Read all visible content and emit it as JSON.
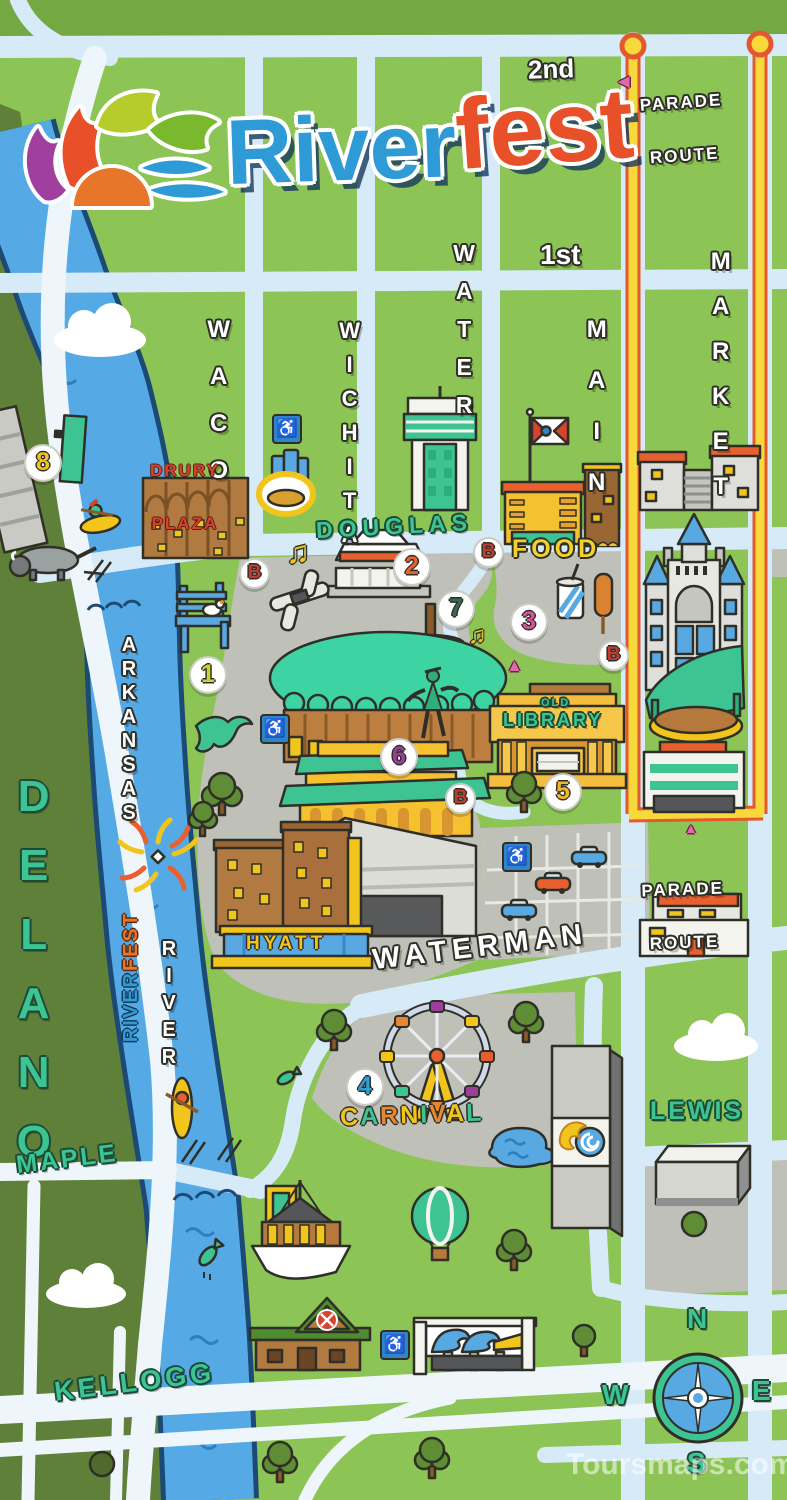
{
  "logo": {
    "blue_word": "River",
    "orange_word": "fest"
  },
  "streets": {
    "second": "2nd",
    "first": "1st",
    "waco": "WACO",
    "wichita": "WICHITA",
    "water": "WATER",
    "main": "MAIN",
    "market": "MARKET",
    "douglas": "DOUGLAS",
    "waterman": "WATERMAN",
    "lewis": "LEWIS",
    "maple": "MAPLE",
    "kellogg": "KELLOGG",
    "delano": "DELANO"
  },
  "river_label": {
    "line1": "ARKANSAS",
    "line2": "RIVER"
  },
  "banner": {
    "river": "RIVER",
    "fest": "FEST"
  },
  "parade": {
    "line1": "PARADE",
    "line2": "ROUTE"
  },
  "venues": {
    "drury1": "DRURY",
    "drury2": "PLAZA",
    "old": "OLD",
    "library": "LIBRARY",
    "hyatt": "HYATT",
    "food": "FOOD",
    "carnival": "CARNIVAL"
  },
  "markers": {
    "m1": "1",
    "m2": "2",
    "m3": "3",
    "m4": "4",
    "m5": "5",
    "m6": "6",
    "m7": "7",
    "m8": "8",
    "b": "B"
  },
  "compass": {
    "n": "N",
    "w": "W",
    "e": "E",
    "s": "S"
  },
  "icons": {
    "music_note": "♫",
    "accessibility": "♿",
    "arrow_up": "▲",
    "arrow_left": "◀"
  },
  "watermark": "Toursmaps.com",
  "colors": {
    "map_green": "#8cc455",
    "west_green": "#5e8038",
    "road_blue": "#d6eaf8",
    "river_blue": "#55aae6",
    "ground_gray": "#bfc0b8",
    "parade_yellow": "#f8d93c",
    "parade_orange": "#e2592f",
    "teal_text": "#3cc492",
    "logo_blue": "#2e9bd6",
    "logo_orange": "#e8502a"
  }
}
